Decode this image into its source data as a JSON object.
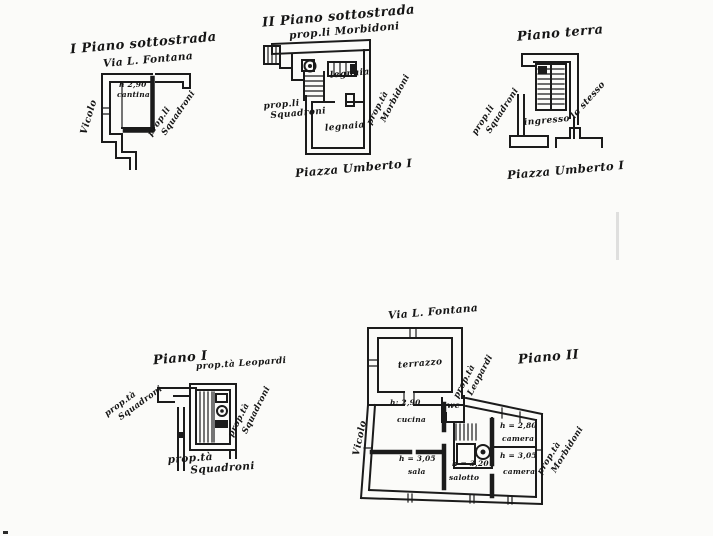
{
  "page": {
    "background": "#fbfbf9",
    "ink": "#1b1b1b"
  },
  "plan_basement1": {
    "title": "I Piano sottostrada",
    "street": "Via L. Fontana",
    "room_height": "h 2,90",
    "room_name": "cantina",
    "side_street": "Vicolo",
    "owner_line1": "prop.li",
    "owner_line2": "Squadroni"
  },
  "plan_basement2": {
    "title": "II Piano sottostrada",
    "owner_top": "prop.li Morbidoni",
    "room_upper": "legnaia",
    "room_lower": "legnaia",
    "owner_left_line1": "prop.li",
    "owner_left_line2": "Squadroni",
    "owner_right_line1": "prop.tà",
    "owner_right_line2": "Morbidoni",
    "caption": "Piazza Umberto I"
  },
  "plan_ground": {
    "title": "Piano terra",
    "owner_left_line1": "prop.li",
    "owner_left_line2": "Squadroni",
    "room_entrance": "ingresso",
    "owner_right": "lo stesso",
    "caption": "Piazza Umberto I"
  },
  "plan_first": {
    "title": "Piano I",
    "owner_top": "prop.tà Leopardi",
    "owner_left_line1": "prop.tà",
    "owner_left_line2": "Squadroni",
    "owner_right_line1": "prop.tà",
    "owner_right_line2": "Squadroni",
    "owner_bottom_line1": "prop.tà",
    "owner_bottom_line2": "Squadroni"
  },
  "plan_second": {
    "title": "Piano II",
    "street_top": "Via L. Fontana",
    "side_street": "Vicolo",
    "terrace": "terrazzo",
    "owner_ne_line1": "prop.tà",
    "owner_ne_line2": "Leopardi",
    "wc": "wc",
    "kitchen_height": "h: 2,90",
    "kitchen": "cucina",
    "hall_height": "h = 3,05",
    "hall": "sala",
    "sitting_height": "h = 3,20",
    "sitting": "salotto",
    "bedroom1_height": "h = 2,80",
    "bedroom1": "camera",
    "bedroom2_height": "h = 3,05",
    "bedroom2": "camera",
    "owner_se_line1": "prop.tà",
    "owner_se_line2": "Morbidoni"
  }
}
